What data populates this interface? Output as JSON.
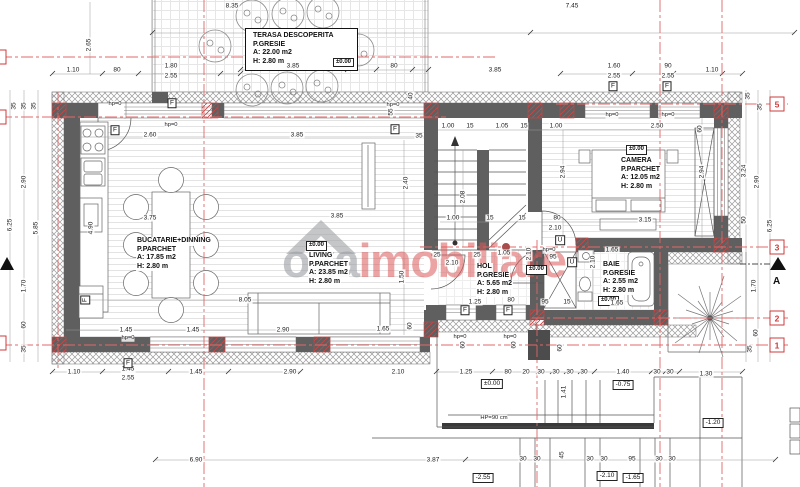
{
  "watermark": {
    "brand_gray": "oxa",
    "brand_red": "imobiliare"
  },
  "section": {
    "label": "A"
  },
  "rooms": [
    {
      "id": "terasa",
      "title": "TERASA DESCOPERITA",
      "floor": "P.GRESIE",
      "area": "A: 22.00 m2",
      "height": "H: 2.80 m",
      "level": "±0.00"
    },
    {
      "id": "bucatarie",
      "title": "BUCATARIE+DINNING",
      "floor": "P.PARCHET",
      "area": "A: 17.85 m2",
      "height": "H: 2.80 m",
      "level": ""
    },
    {
      "id": "living",
      "title": "LIVING",
      "floor": "P.PARCHET",
      "area": "A: 23.85 m2",
      "height": "H: 2.80 m",
      "level": "±0.00"
    },
    {
      "id": "hol",
      "title": "HOL",
      "floor": "P.GRESIE",
      "area": "A: 5.65 m2",
      "height": "H: 2.80 m",
      "level": "±0.00"
    },
    {
      "id": "camera",
      "title": "CAMERA",
      "floor": "P.PARCHET",
      "area": "A: 12.05 m2",
      "height": "H: 2.80 m",
      "level": "±0.00"
    },
    {
      "id": "baie",
      "title": "BAIE",
      "floor": "P.GRESIE",
      "area": "A: 2.55 m2",
      "height": "H: 2.80 m",
      "level": "±0.00"
    }
  ],
  "axis_markers": [
    {
      "t": "5",
      "x": 777,
      "y": 104
    },
    {
      "t": "3",
      "x": 777,
      "y": 247
    },
    {
      "t": "2",
      "x": 777,
      "y": 318
    },
    {
      "t": "1",
      "x": 777,
      "y": 345
    },
    {
      "t": "",
      "x": -1,
      "y": 57
    },
    {
      "t": "",
      "x": -1,
      "y": 117
    },
    {
      "t": "",
      "x": -1,
      "y": 343
    }
  ],
  "tags": [
    {
      "t": "F",
      "x": 172,
      "y": 103
    },
    {
      "t": "F",
      "x": 115,
      "y": 130
    },
    {
      "t": "F",
      "x": 395,
      "y": 129
    },
    {
      "t": "F",
      "x": 613,
      "y": 86
    },
    {
      "t": "F",
      "x": 667,
      "y": 86
    },
    {
      "t": "F",
      "x": 128,
      "y": 363
    },
    {
      "t": "F",
      "x": 465,
      "y": 310
    },
    {
      "t": "F",
      "x": 508,
      "y": 310
    },
    {
      "t": "F",
      "x": 85,
      "y": 300,
      "r": 1
    },
    {
      "t": "U",
      "x": 560,
      "y": 240
    },
    {
      "t": "U",
      "x": 572,
      "y": 262
    }
  ],
  "levels": [
    {
      "t": "±0.00",
      "x": 492,
      "y": 384
    },
    {
      "t": "-0.75",
      "x": 623,
      "y": 385
    },
    {
      "t": "-1.20",
      "x": 713,
      "y": 423
    },
    {
      "t": "-2.55",
      "x": 483,
      "y": 478
    },
    {
      "t": "-2.10",
      "x": 607,
      "y": 476
    },
    {
      "t": "-1.65",
      "x": 633,
      "y": 478
    }
  ],
  "notes": [
    {
      "t": "HP=90 cm",
      "x": 494,
      "y": 418
    },
    {
      "t": "hp=0",
      "x": 115,
      "y": 104
    },
    {
      "t": "hp=0",
      "x": 171,
      "y": 125
    },
    {
      "t": "hp=0",
      "x": 393,
      "y": 105
    },
    {
      "t": "hp=0",
      "x": 612,
      "y": 115
    },
    {
      "t": "hp=0",
      "x": 668,
      "y": 115
    },
    {
      "t": "hp=0",
      "x": 128,
      "y": 338
    },
    {
      "t": "hp=0",
      "x": 460,
      "y": 337
    },
    {
      "t": "hp=0",
      "x": 510,
      "y": 337
    },
    {
      "t": "hp=0",
      "x": 549,
      "y": 250
    }
  ],
  "dims": [
    {
      "t": "8.35",
      "x": 232,
      "y": 6
    },
    {
      "t": "7.45",
      "x": 572,
      "y": 6
    },
    {
      "t": "2.65",
      "x": 89,
      "y": 45,
      "r": 1
    },
    {
      "t": "1.10",
      "x": 73,
      "y": 70
    },
    {
      "t": "80",
      "x": 117,
      "y": 70
    },
    {
      "t": "1.80",
      "x": 171,
      "y": 66
    },
    {
      "t": "2.55",
      "x": 171,
      "y": 76
    },
    {
      "t": "3.85",
      "x": 293,
      "y": 66
    },
    {
      "t": "80",
      "x": 394,
      "y": 66
    },
    {
      "t": "3.85",
      "x": 495,
      "y": 70
    },
    {
      "t": "1.60",
      "x": 614,
      "y": 66
    },
    {
      "t": "2.55",
      "x": 614,
      "y": 76
    },
    {
      "t": "90",
      "x": 668,
      "y": 66
    },
    {
      "t": "2.55",
      "x": 668,
      "y": 76
    },
    {
      "t": "1.10",
      "x": 712,
      "y": 70
    },
    {
      "t": "35",
      "x": 14,
      "y": 106,
      "r": 1
    },
    {
      "t": "35",
      "x": 24,
      "y": 106,
      "r": 1
    },
    {
      "t": "35",
      "x": 34,
      "y": 106,
      "r": 1
    },
    {
      "t": "2.90",
      "x": 24,
      "y": 182,
      "r": 1
    },
    {
      "t": "6.25",
      "x": 10,
      "y": 225,
      "r": 1
    },
    {
      "t": "5.85",
      "x": 36,
      "y": 228,
      "r": 1
    },
    {
      "t": "1.70",
      "x": 24,
      "y": 286,
      "r": 1
    },
    {
      "t": "60",
      "x": 24,
      "y": 325,
      "r": 1
    },
    {
      "t": "35",
      "x": 24,
      "y": 349,
      "r": 1
    },
    {
      "t": "35",
      "x": 748,
      "y": 96,
      "r": 1
    },
    {
      "t": "35",
      "x": 760,
      "y": 107,
      "r": 1
    },
    {
      "t": "3.24",
      "x": 744,
      "y": 171,
      "r": 1
    },
    {
      "t": "2.90",
      "x": 757,
      "y": 182,
      "r": 1
    },
    {
      "t": "50",
      "x": 744,
      "y": 220,
      "r": 1
    },
    {
      "t": "6.25",
      "x": 770,
      "y": 226,
      "r": 1
    },
    {
      "t": "1.70",
      "x": 754,
      "y": 286,
      "r": 1
    },
    {
      "t": "60",
      "x": 756,
      "y": 333,
      "r": 1
    },
    {
      "t": "35",
      "x": 750,
      "y": 349,
      "r": 1
    },
    {
      "t": "60",
      "x": 700,
      "y": 129,
      "r": 1
    },
    {
      "t": "2.94",
      "x": 702,
      "y": 172,
      "r": 1
    },
    {
      "t": "2.60",
      "x": 150,
      "y": 135
    },
    {
      "t": "3.85",
      "x": 297,
      "y": 135
    },
    {
      "t": "3.75",
      "x": 150,
      "y": 218
    },
    {
      "t": "3.85",
      "x": 337,
      "y": 216
    },
    {
      "t": "8.05",
      "x": 245,
      "y": 300
    },
    {
      "t": "1.45",
      "x": 126,
      "y": 330
    },
    {
      "t": "1.45",
      "x": 193,
      "y": 330
    },
    {
      "t": "2.90",
      "x": 283,
      "y": 330
    },
    {
      "t": "1.65",
      "x": 383,
      "y": 329
    },
    {
      "t": "4.90",
      "x": 91,
      "y": 228,
      "r": 1
    },
    {
      "t": "2.40",
      "x": 406,
      "y": 183,
      "r": 1
    },
    {
      "t": "1.50",
      "x": 402,
      "y": 277,
      "r": 1
    },
    {
      "t": "60",
      "x": 410,
      "y": 326,
      "r": 1
    },
    {
      "t": "40",
      "x": 411,
      "y": 96,
      "r": 1
    },
    {
      "t": "55",
      "x": 391,
      "y": 112,
      "r": 1
    },
    {
      "t": "35",
      "x": 419,
      "y": 136
    },
    {
      "t": "1.00",
      "x": 448,
      "y": 126
    },
    {
      "t": "15",
      "x": 470,
      "y": 126
    },
    {
      "t": "1.05",
      "x": 502,
      "y": 126
    },
    {
      "t": "15",
      "x": 524,
      "y": 126
    },
    {
      "t": "1.00",
      "x": 556,
      "y": 126
    },
    {
      "t": "2.08",
      "x": 463,
      "y": 197,
      "r": 1
    },
    {
      "t": "2.94",
      "x": 563,
      "y": 172,
      "r": 1
    },
    {
      "t": "1.00",
      "x": 453,
      "y": 218
    },
    {
      "t": "15",
      "x": 490,
      "y": 218
    },
    {
      "t": "15",
      "x": 522,
      "y": 218
    },
    {
      "t": "80",
      "x": 557,
      "y": 218
    },
    {
      "t": "2.10",
      "x": 555,
      "y": 228
    },
    {
      "t": "25",
      "x": 437,
      "y": 255
    },
    {
      "t": "2.10",
      "x": 452,
      "y": 263
    },
    {
      "t": "25",
      "x": 477,
      "y": 255
    },
    {
      "t": "1.05",
      "x": 504,
      "y": 253
    },
    {
      "t": "95",
      "x": 553,
      "y": 257
    },
    {
      "t": "1.25",
      "x": 475,
      "y": 302
    },
    {
      "t": "80",
      "x": 511,
      "y": 300
    },
    {
      "t": "95",
      "x": 545,
      "y": 302
    },
    {
      "t": "15",
      "x": 567,
      "y": 302
    },
    {
      "t": "2.50",
      "x": 657,
      "y": 126
    },
    {
      "t": "3.15",
      "x": 645,
      "y": 220
    },
    {
      "t": "1.65",
      "x": 612,
      "y": 250
    },
    {
      "t": "2.10",
      "x": 593,
      "y": 262,
      "r": 1
    },
    {
      "t": "2.10",
      "x": 529,
      "y": 254,
      "r": 1
    },
    {
      "t": "1.65",
      "x": 617,
      "y": 303
    },
    {
      "t": "1.10",
      "x": 74,
      "y": 372
    },
    {
      "t": "1.45",
      "x": 128,
      "y": 369
    },
    {
      "t": "2.55",
      "x": 128,
      "y": 378
    },
    {
      "t": "1.45",
      "x": 196,
      "y": 372
    },
    {
      "t": "2.90",
      "x": 290,
      "y": 372
    },
    {
      "t": "2.10",
      "x": 398,
      "y": 372
    },
    {
      "t": "1.25",
      "x": 466,
      "y": 372
    },
    {
      "t": "80",
      "x": 508,
      "y": 372
    },
    {
      "t": "20",
      "x": 526,
      "y": 372
    },
    {
      "t": "30",
      "x": 541,
      "y": 372
    },
    {
      "t": "30",
      "x": 556,
      "y": 372
    },
    {
      "t": "30",
      "x": 570,
      "y": 372
    },
    {
      "t": "30",
      "x": 584,
      "y": 372
    },
    {
      "t": "1.40",
      "x": 623,
      "y": 372
    },
    {
      "t": "30",
      "x": 657,
      "y": 372
    },
    {
      "t": "30",
      "x": 670,
      "y": 372
    },
    {
      "t": "1.30",
      "x": 706,
      "y": 374
    },
    {
      "t": "60",
      "x": 463,
      "y": 345,
      "r": 1
    },
    {
      "t": "60",
      "x": 514,
      "y": 345,
      "r": 1
    },
    {
      "t": "60",
      "x": 560,
      "y": 348,
      "r": 1
    },
    {
      "t": "1.41",
      "x": 564,
      "y": 392,
      "r": 1
    },
    {
      "t": "45",
      "x": 562,
      "y": 455,
      "r": 1
    },
    {
      "t": "6.90",
      "x": 196,
      "y": 460
    },
    {
      "t": "3.87",
      "x": 433,
      "y": 460
    },
    {
      "t": "30",
      "x": 523,
      "y": 459
    },
    {
      "t": "30",
      "x": 537,
      "y": 459
    },
    {
      "t": "30",
      "x": 590,
      "y": 459
    },
    {
      "t": "30",
      "x": 604,
      "y": 459
    },
    {
      "t": "95",
      "x": 632,
      "y": 459
    },
    {
      "t": "30",
      "x": 659,
      "y": 459
    },
    {
      "t": "30",
      "x": 672,
      "y": 459
    }
  ],
  "colors": {
    "wall": "#5f5f5f",
    "axis_red": "#e06868",
    "marker_red": "#cc3b3b",
    "watermark_gray": "#9da0a4",
    "watermark_red": "#dd5858"
  }
}
